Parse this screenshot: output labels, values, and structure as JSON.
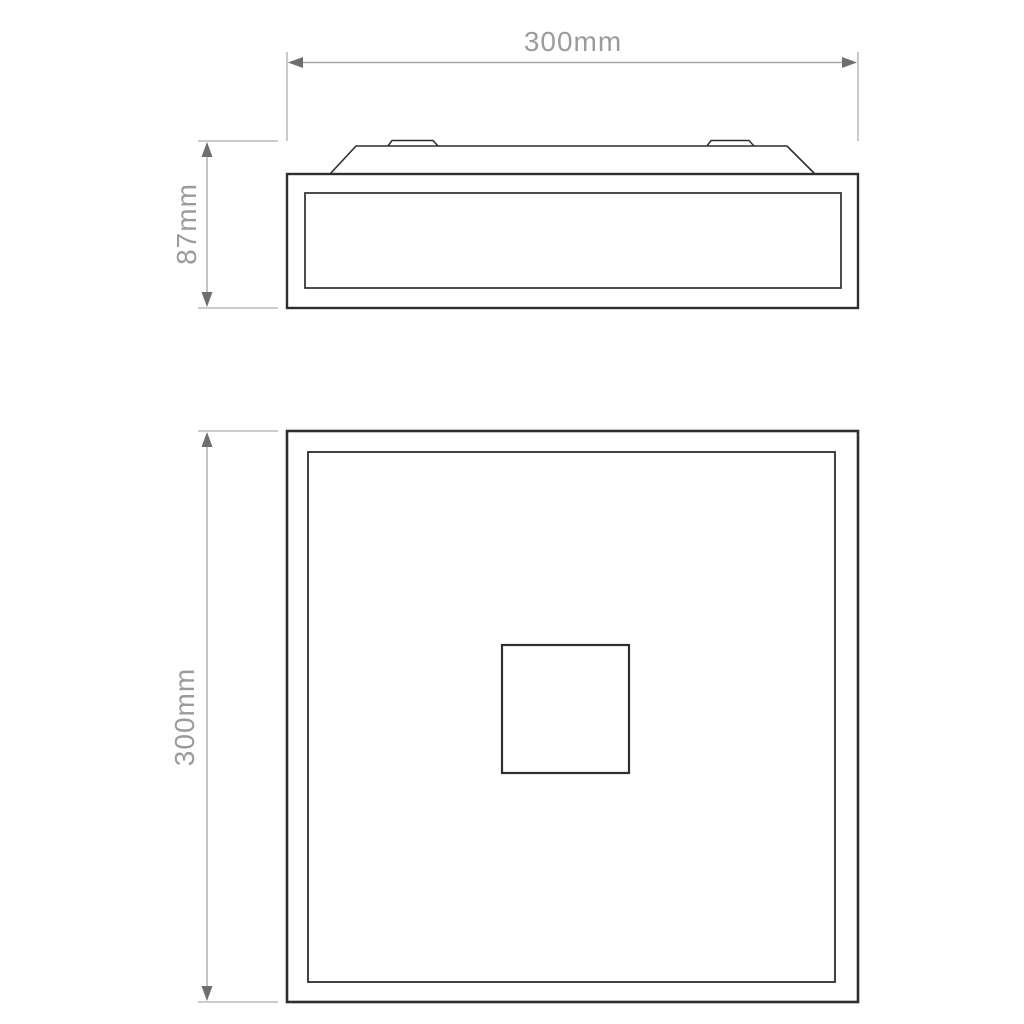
{
  "drawing": {
    "dimensions": {
      "top_width": {
        "label": "300mm"
      },
      "side_height": {
        "label": "87mm"
      },
      "plan_height": {
        "label": "300mm"
      }
    }
  },
  "colors": {
    "line_dark": "#2e2e2e",
    "extension_line": "#bcbcbc",
    "dim_line": "#a8a8a8",
    "arrowhead": "#6e6e6e",
    "label_text": "#9b9b9b",
    "background": "#ffffff"
  }
}
